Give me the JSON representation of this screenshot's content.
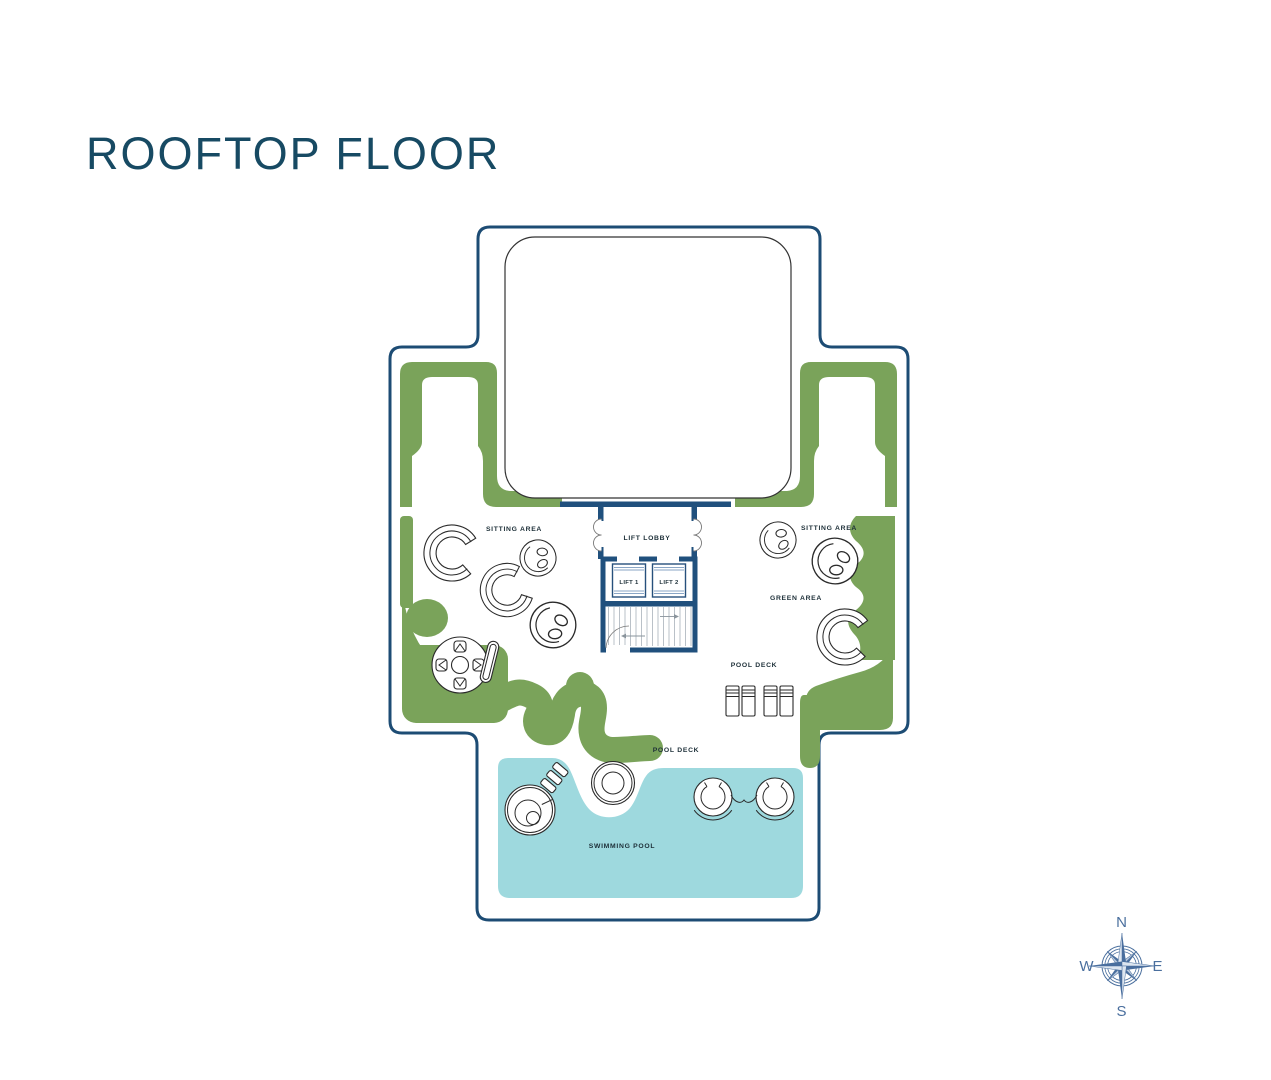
{
  "page": {
    "title": "ROOFTOP FLOOR"
  },
  "colors": {
    "title": "#174a63",
    "boundary": "#1d4c74",
    "walls": "#20507d",
    "green_area": "#7aa35a",
    "pool_water": "#9ed9de",
    "compass": "#4a6f9e",
    "labels": "#1d2f38"
  },
  "labels": {
    "sitting_area_left": "SITTING AREA",
    "sitting_area_right": "SITTING AREA",
    "lift_lobby": "LIFT LOBBY",
    "lift_1": "LIFT 1",
    "lift_2": "LIFT 2",
    "green_area": "GREEN AREA",
    "pool_deck_upper": "POOL DECK",
    "pool_deck_lower": "POOL DECK",
    "swimming_pool": "SWIMMING POOL"
  },
  "compass": {
    "north": "N",
    "east": "E",
    "south": "S",
    "west": "W"
  }
}
